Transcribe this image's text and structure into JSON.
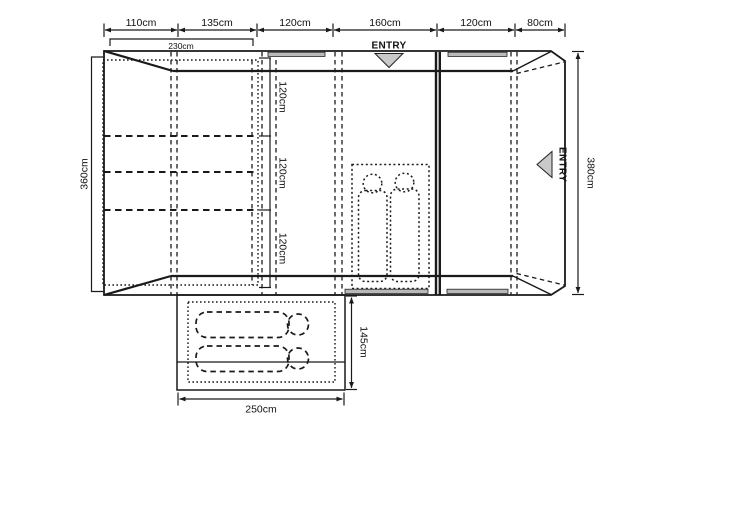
{
  "dims": {
    "top": [
      "110cm",
      "135cm",
      "120cm",
      "160cm",
      "120cm",
      "80cm"
    ],
    "inner_width": "230cm",
    "left_height": "360cm",
    "right_height": "380cm",
    "bed_sections": [
      "120cm",
      "120cm",
      "120cm"
    ],
    "annex_depth": "145cm",
    "annex_width": "250cm"
  },
  "labels": {
    "entry_top": "ENTRY",
    "entry_side": "ENTRY"
  },
  "colors": {
    "inner_tent": "#dedede",
    "sleeping_bag": "#ffffff",
    "door": "#c9c9c9",
    "vent": "#b9b9b9",
    "line": "#1a1a1a"
  }
}
